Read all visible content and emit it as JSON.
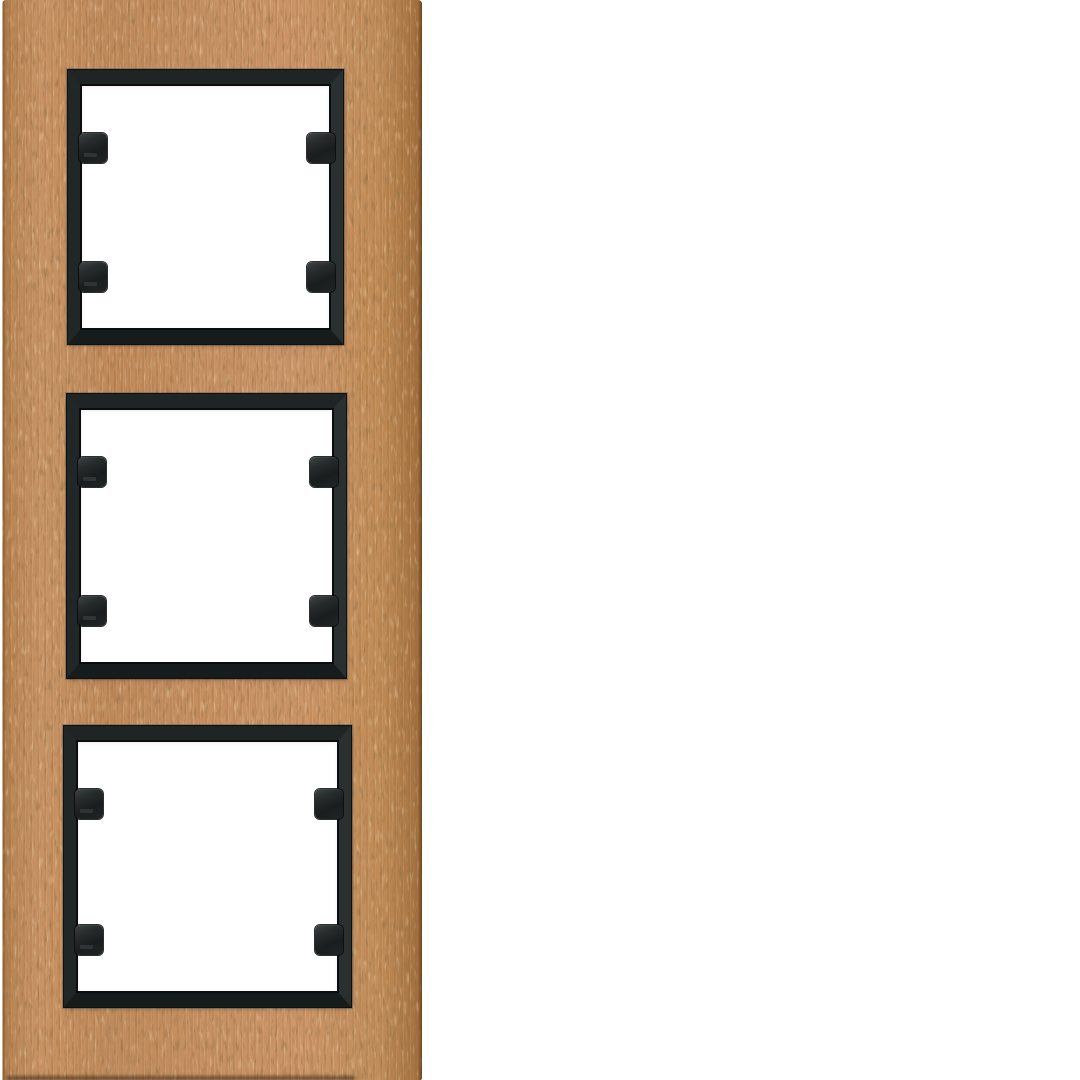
{
  "scene": {
    "type": "product-photo",
    "description": "Vertical 3-gang wooden cover frame for modular light switches: light beech wood plate with three square black beveled module openings, each opening with four black mounting clips, photographed on a plain white background",
    "background_color": "#ffffff"
  },
  "product": {
    "name": "3-gang wooden switch frame",
    "orientation": "vertical",
    "gang_count": 3,
    "material": "beech wood",
    "wood": {
      "base_color": "#c28a58",
      "light_grain_color": "#dcab77",
      "dark_grain_color": "#7b4f2c",
      "edge_shade_color": "#96653a"
    },
    "module_frame": {
      "color": "#1e2323",
      "bevel_highlight": "#3c4141",
      "opening_color": "#ffffff"
    },
    "clips": {
      "color": "#1a1d1d",
      "per_opening": 4,
      "total": 12
    }
  },
  "openings": [
    {
      "label": "opening-1",
      "position": "top"
    },
    {
      "label": "opening-2",
      "position": "middle"
    },
    {
      "label": "opening-3",
      "position": "bottom"
    }
  ]
}
